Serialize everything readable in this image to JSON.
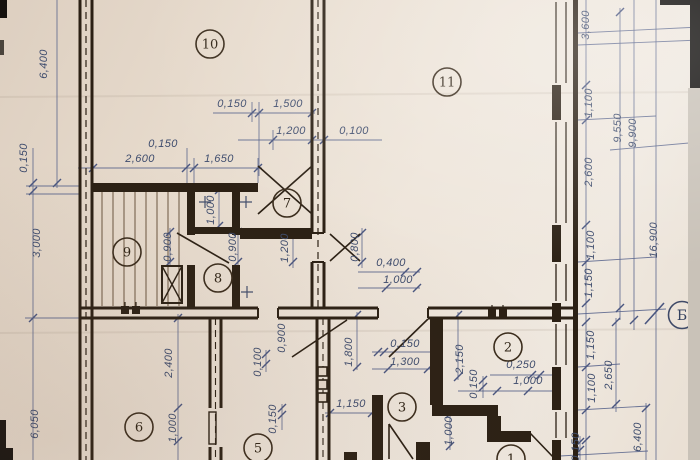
{
  "drawing": {
    "type": "architectural floor plan photo",
    "axis_marker": "Б",
    "ink_color": "#3e4c6d",
    "wall_color": "#2b2014",
    "paper_color": "#e7dbcd"
  },
  "rooms": [
    {
      "number": "10",
      "x": 210,
      "y": 44
    },
    {
      "number": "11",
      "x": 447,
      "y": 82
    },
    {
      "number": "7",
      "x": 287,
      "y": 203
    },
    {
      "number": "9",
      "x": 127,
      "y": 252
    },
    {
      "number": "8",
      "x": 218,
      "y": 278
    },
    {
      "number": "2",
      "x": 508,
      "y": 347
    },
    {
      "number": "3",
      "x": 402,
      "y": 407
    },
    {
      "number": "6",
      "x": 139,
      "y": 427
    },
    {
      "number": "5",
      "x": 258,
      "y": 448
    },
    {
      "number": "1",
      "x": 511,
      "y": 459
    }
  ],
  "axis_markers": [
    {
      "label": "Б",
      "x": 682,
      "y": 315
    }
  ],
  "dimensions": [
    {
      "text": "6,400",
      "x": 47,
      "y": 64,
      "rot": -90
    },
    {
      "text": "0,150",
      "x": 27,
      "y": 158,
      "rot": -90
    },
    {
      "text": "3,000",
      "x": 40,
      "y": 243,
      "rot": -90
    },
    {
      "text": "6,050",
      "x": 38,
      "y": 424,
      "rot": -90
    },
    {
      "text": "0,150",
      "x": 232,
      "y": 107,
      "rot": 0
    },
    {
      "text": "1,500",
      "x": 288,
      "y": 107,
      "rot": 0
    },
    {
      "text": "1,200",
      "x": 291,
      "y": 134,
      "rot": 0
    },
    {
      "text": "0,100",
      "x": 354,
      "y": 134,
      "rot": 0
    },
    {
      "text": "0,150",
      "x": 163,
      "y": 147,
      "rot": 0
    },
    {
      "text": "2,600",
      "x": 140,
      "y": 162,
      "rot": 0
    },
    {
      "text": "1,650",
      "x": 219,
      "y": 162,
      "rot": 0
    },
    {
      "text": "1,000",
      "x": 214,
      "y": 210,
      "rot": -90
    },
    {
      "text": "0,900",
      "x": 171,
      "y": 247,
      "rot": -90
    },
    {
      "text": "0,900",
      "x": 236,
      "y": 247,
      "rot": -90
    },
    {
      "text": "1,200",
      "x": 288,
      "y": 248,
      "rot": -90
    },
    {
      "text": "0,800",
      "x": 358,
      "y": 247,
      "rot": -90
    },
    {
      "text": "0,400",
      "x": 391,
      "y": 266,
      "rot": 0
    },
    {
      "text": "1,000",
      "x": 398,
      "y": 283,
      "rot": 0
    },
    {
      "text": "3,600",
      "x": 589,
      "y": 25,
      "rot": -90
    },
    {
      "text": "1,100",
      "x": 592,
      "y": 103,
      "rot": -90
    },
    {
      "text": "2,600",
      "x": 592,
      "y": 172,
      "rot": -90
    },
    {
      "text": "1,100",
      "x": 594,
      "y": 245,
      "rot": -90
    },
    {
      "text": "1,150",
      "x": 592,
      "y": 283,
      "rot": -90
    },
    {
      "text": "9,550",
      "x": 621,
      "y": 128,
      "rot": -90
    },
    {
      "text": "9,900",
      "x": 636,
      "y": 133,
      "rot": -90
    },
    {
      "text": "16,900",
      "x": 657,
      "y": 240,
      "rot": -90
    },
    {
      "text": "1,150",
      "x": 594,
      "y": 345,
      "rot": -90
    },
    {
      "text": "2,650",
      "x": 612,
      "y": 375,
      "rot": -90
    },
    {
      "text": "1,100",
      "x": 595,
      "y": 388,
      "rot": -90
    },
    {
      "text": "6,400",
      "x": 641,
      "y": 437,
      "rot": -90
    },
    {
      "text": "0,150",
      "x": 579,
      "y": 447,
      "rot": -90
    },
    {
      "text": "0,900",
      "x": 285,
      "y": 338,
      "rot": -90
    },
    {
      "text": "0,100",
      "x": 261,
      "y": 362,
      "rot": -90
    },
    {
      "text": "1,800",
      "x": 352,
      "y": 352,
      "rot": -90
    },
    {
      "text": "0,150",
      "x": 405,
      "y": 347,
      "rot": 0
    },
    {
      "text": "1,300",
      "x": 405,
      "y": 365,
      "rot": 0
    },
    {
      "text": "2,150",
      "x": 463,
      "y": 359,
      "rot": -90
    },
    {
      "text": "1,000",
      "x": 452,
      "y": 431,
      "rot": -90
    },
    {
      "text": "0,250",
      "x": 521,
      "y": 368,
      "rot": 0
    },
    {
      "text": "1,000",
      "x": 528,
      "y": 384,
      "rot": 0
    },
    {
      "text": "0,150",
      "x": 477,
      "y": 384,
      "rot": -90
    },
    {
      "text": "1,150",
      "x": 351,
      "y": 407,
      "rot": 0
    },
    {
      "text": "0,150",
      "x": 276,
      "y": 419,
      "rot": -90
    },
    {
      "text": "2,400",
      "x": 172,
      "y": 363,
      "rot": -90
    },
    {
      "text": "1,000",
      "x": 176,
      "y": 428,
      "rot": -90
    }
  ]
}
